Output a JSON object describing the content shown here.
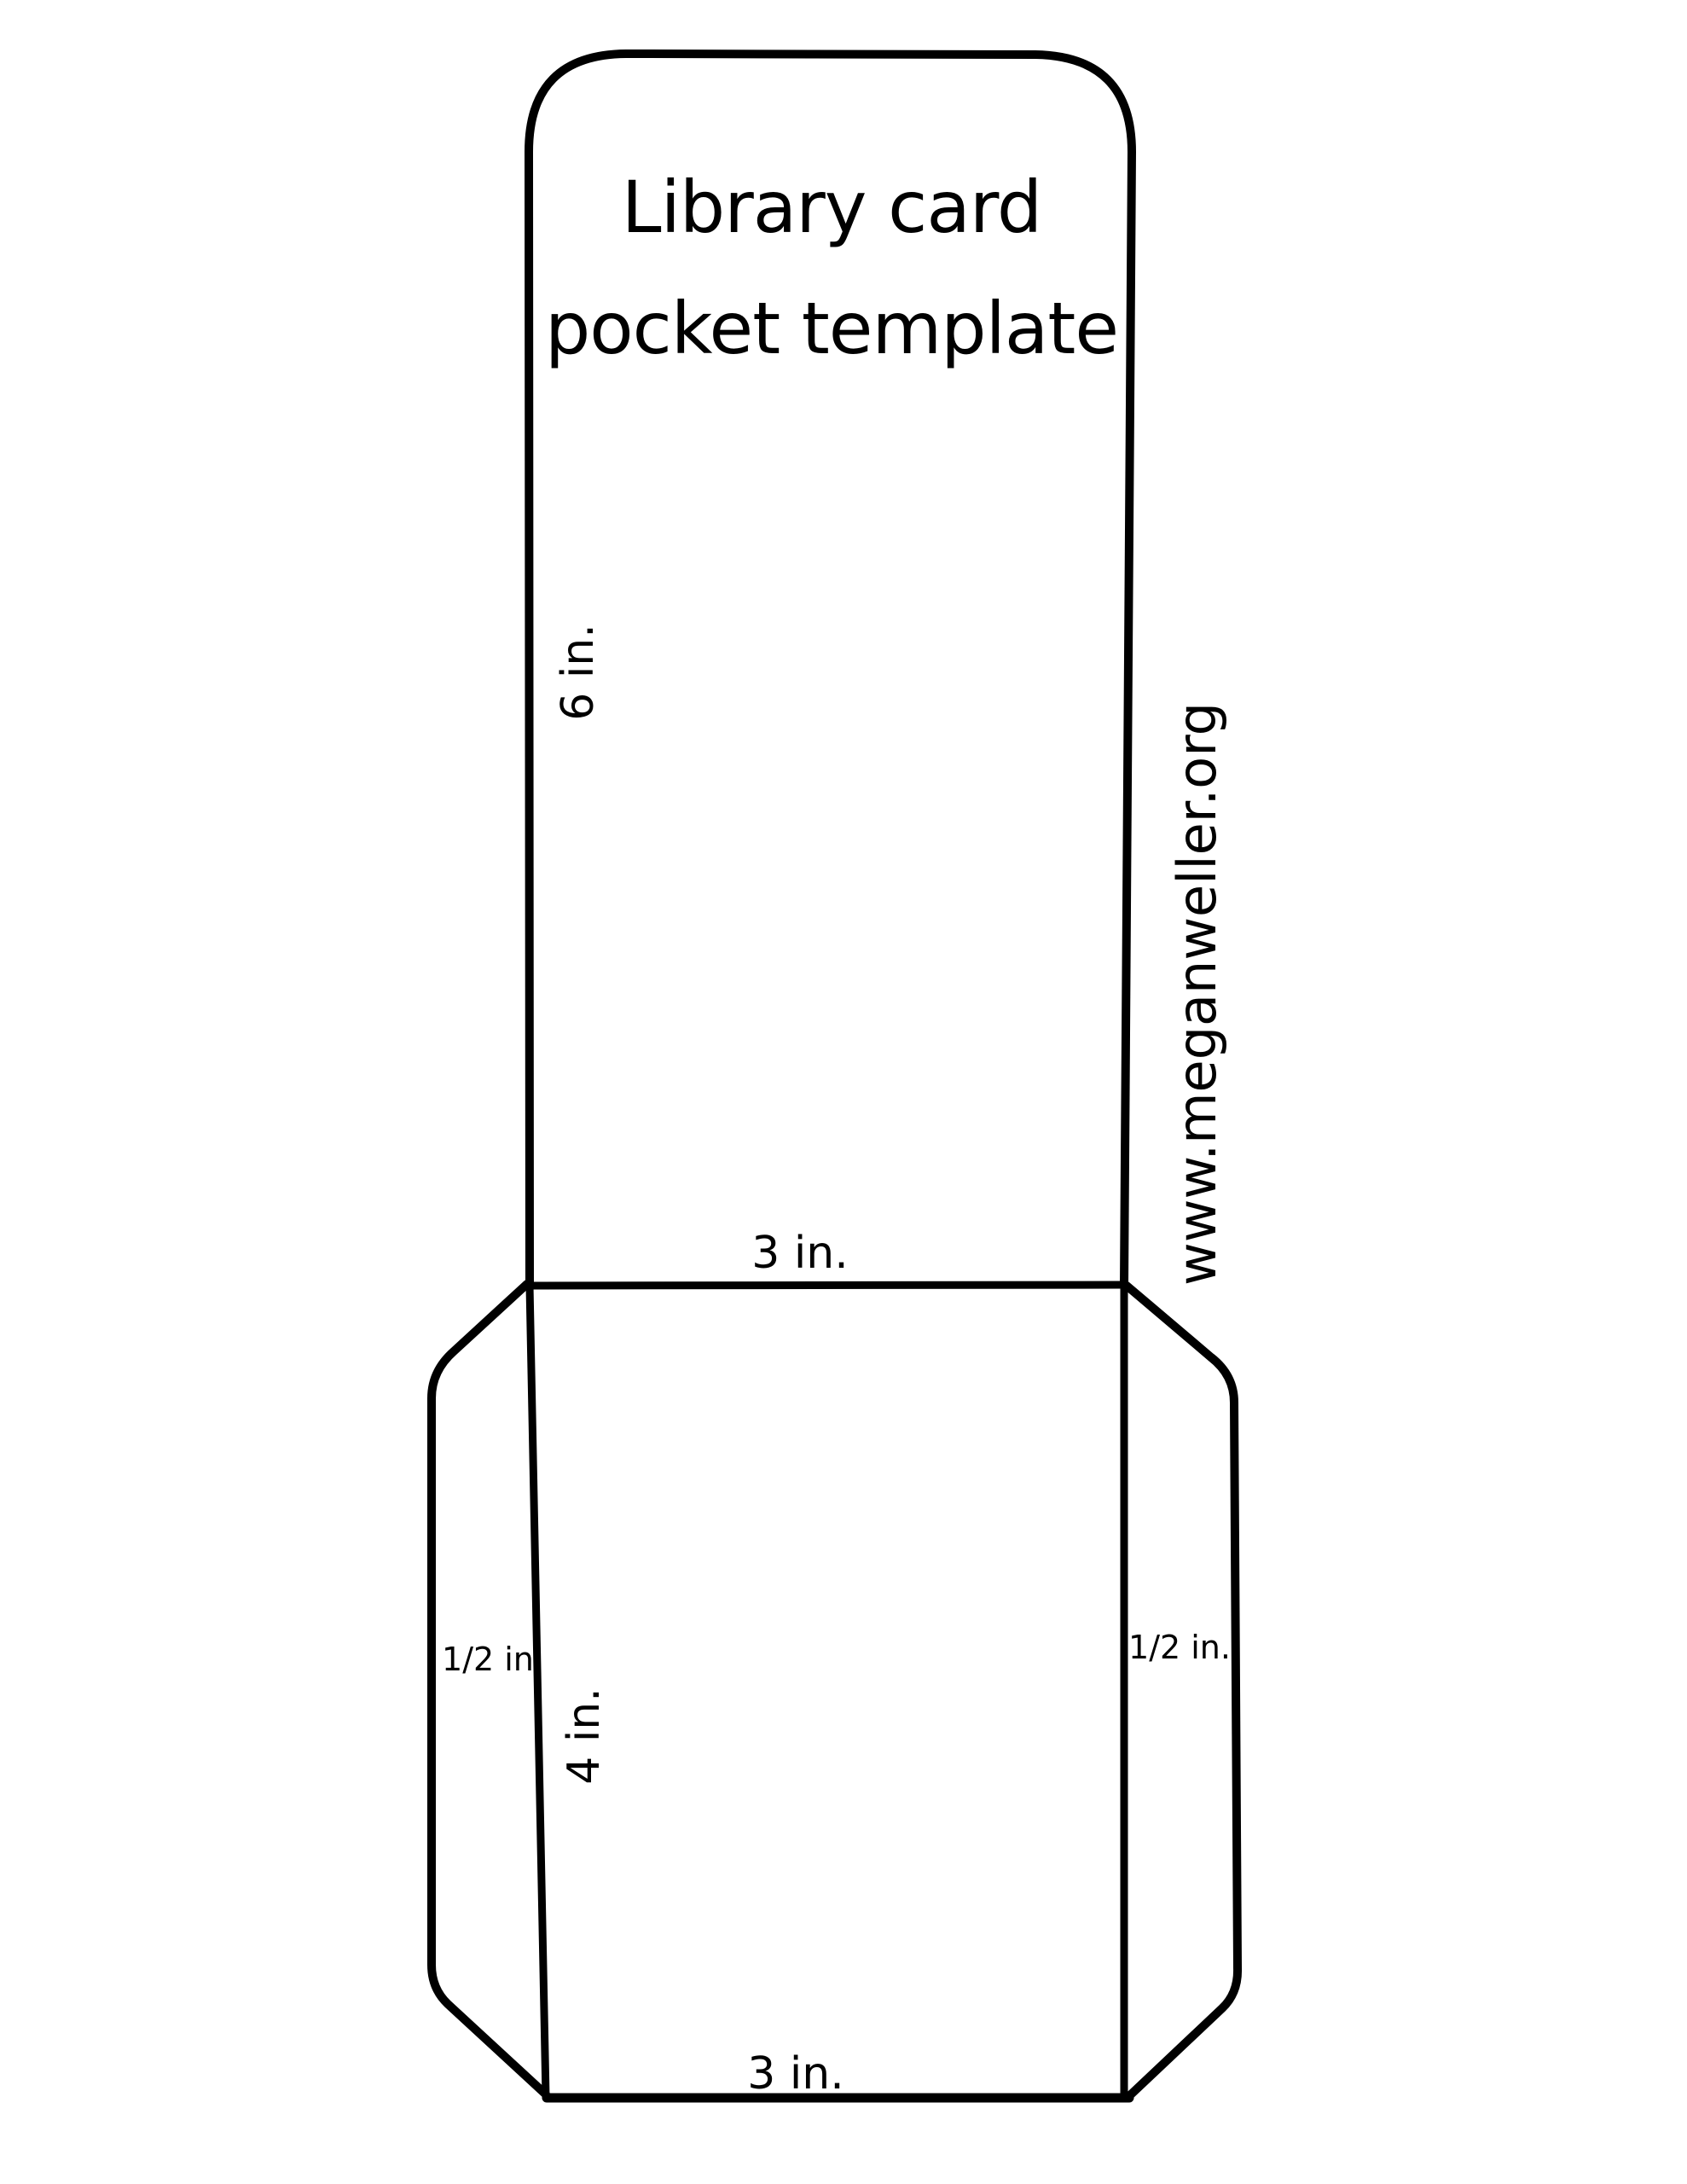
{
  "page": {
    "background": "#ffffff",
    "ink": "#000000"
  },
  "title": {
    "line1": "Library card",
    "line2": "pocket template"
  },
  "dimensions": {
    "card_height": "6 in.",
    "card_width": "3 in.",
    "pocket_height": "4 in.",
    "pocket_bottom_width": "3 in.",
    "left_flap_width": "1/2 in.",
    "right_flap_width": "1/2 in."
  },
  "website": "www.meganweller.org"
}
